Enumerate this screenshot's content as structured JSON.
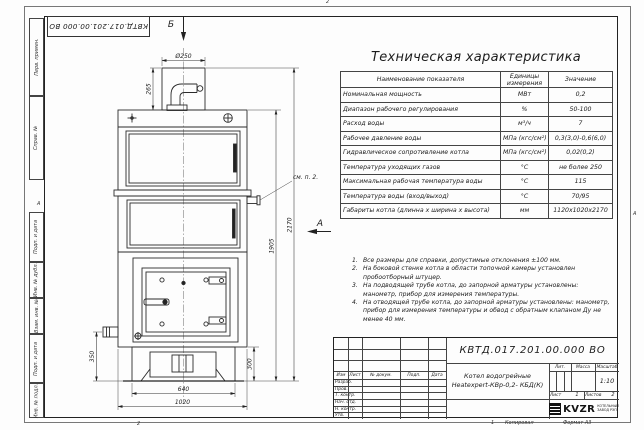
{
  "frame": {
    "left_fields": [
      "Перв. примен.",
      "Справ. №",
      "Подп. и дата",
      "Инв. № дубл.",
      "Взам. инв. №",
      "Подп. и дата",
      "Инв. № подл."
    ],
    "zone_left": "А",
    "zone_right": "А",
    "fold_mark": "2",
    "sheet_mark": "1",
    "copied_label": "Копировал",
    "format_label": "Формат А3"
  },
  "top_box": {
    "number": "КВТД.017.201.00.000 ВО"
  },
  "views": {
    "b_label": "Б",
    "a_label": "А",
    "callout_note": "см. п. 2."
  },
  "dims": {
    "d250": "Ø250",
    "h265": "265",
    "h2170": "2170",
    "h1905": "1905",
    "h350": "350",
    "h300": "300",
    "w640": "640",
    "w1020": "1020"
  },
  "spec_table": {
    "title": "Техническая характеристика",
    "headers": {
      "name": "Наименование показателя",
      "units_1": "Единицы",
      "units_2": "измерения",
      "value": "Значение"
    },
    "rows": [
      {
        "name": "Номинальная мощность",
        "unit": "МВт",
        "value": "0,2"
      },
      {
        "name": "Диапазон рабочего регулирования",
        "unit": "%",
        "value": "50-100"
      },
      {
        "name": "Расход воды",
        "unit": "м³/ч",
        "value": "7"
      },
      {
        "name": "Рабочее давление воды",
        "unit": "МПа (кгс/см²)",
        "value": "0,3(3,0)-0,6(6,0)"
      },
      {
        "name": "Гидравлическое сопротивление котла",
        "unit": "МПа (кгс/см²)",
        "value": "0,02(0,2)"
      },
      {
        "name": "Температура уходящих газов",
        "unit": "°С",
        "value": "не более 250"
      },
      {
        "name": "Максимальная рабочая температура воды",
        "unit": "°С",
        "value": "115"
      },
      {
        "name": "Температура воды (вход/выход)",
        "unit": "°С",
        "value": "70/95"
      },
      {
        "name": "Габариты котла (длинна х ширина х высота)",
        "unit": "мм",
        "value": "1120х1020х2170"
      }
    ]
  },
  "notes": {
    "items": [
      {
        "num": "1.",
        "text": "Все размеры для справки, допустимые отклонения ±100 мм."
      },
      {
        "num": "2.",
        "text": "На боковой стенке котла в области топочной камеры установлен пробоотборный штуцер."
      },
      {
        "num": "3.",
        "text": "На подводящей трубе котла, до запорной арматуры установлены: манометр, прибор для измерения температуры."
      },
      {
        "num": "4.",
        "text": "На отводящей трубе котла, до запорной арматуры установлены: манометр, прибор для измерения температуры и обвод с обратным клапаном Ду не менее 40 мм."
      }
    ]
  },
  "stamp": {
    "doc_number": "КВТД.017.201.00.000 ВО",
    "product_line1": "Котел водогрейные",
    "product_line2": "Heatexpert-КВр-0,2- КБД(К)",
    "header_cols": [
      "Изм",
      "Лист",
      "№ докум.",
      "Подп.",
      "Дата"
    ],
    "row_labels": [
      "Разраб.",
      "Пров.",
      "Т. контр.",
      "Нач. отд.",
      "Н. контр.",
      "Утв."
    ],
    "lit_label": "Лит.",
    "mass_label": "Масса",
    "scale_label": "Масштаб",
    "scale_value": "1:10",
    "sheet_label": "Лист",
    "sheet_value": "1",
    "sheets_label": "Листов",
    "sheets_value": "2",
    "logo_text": "KVZR",
    "logo_sub1": "КОТЕЛЬНЫЙ",
    "logo_sub2": "ЗАВОД РЭП"
  }
}
